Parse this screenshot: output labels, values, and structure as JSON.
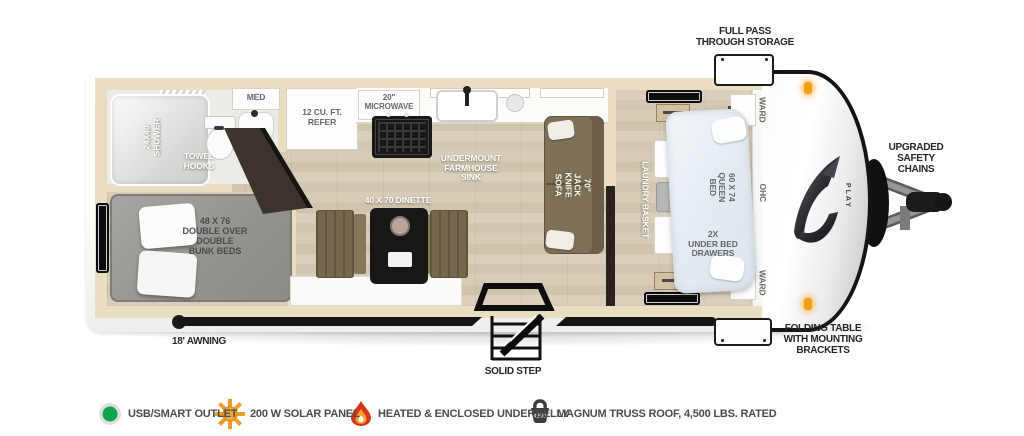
{
  "callouts": {
    "full_pass_through_storage": "FULL PASS\nTHROUGH STORAGE",
    "upgraded_safety_chains": "UPGRADED\nSAFETY\nCHAINS",
    "folding_table": "FOLDING TABLE\nWITH MOUNTING\nBRACKETS",
    "awning": "18' AWNING",
    "solid_step": "SOLID STEP"
  },
  "interior": {
    "shower": "24X40\nSHOWER",
    "towel_hooks": "TOWEL\nHOOKS",
    "med_cabinet": "MED",
    "refrigerator": "12 CU. FT.\nREFER",
    "microwave": "20\"\nMICROWAVE",
    "sink": "UNDERMOUNT\nFARMHOUSE\nSINK",
    "dinette": "40 X 70 DINETTE",
    "sofa": "70\"\nJACK KNIFE SOFA",
    "bunk_beds": "48 X 76\nDOUBLE OVER\nDOUBLE\nBUNK BEDS",
    "laundry_basket": "LAUNDRY BASKET",
    "queen_bed": "60 X 74\nQUEEN BED",
    "under_bed_drawers": "2X\nUNDER BED\nDRAWERS",
    "ward_top": "WARD",
    "ohc": "OHC",
    "ward_bottom": "WARD"
  },
  "front_graphic": {
    "logo_text": "PLAY"
  },
  "legend": {
    "items": [
      {
        "icon": "usb-outlet",
        "label": "USB/SMART OUTLET",
        "color": "#0ea54b"
      },
      {
        "icon": "solar-panel",
        "label": "200 W SOLAR PANEL",
        "color": "#f0a236"
      },
      {
        "icon": "heated-underbelly",
        "label": "HEATED & ENCLOSED UNDERBELLY",
        "color": "#d8341c"
      },
      {
        "icon": "truss-roof-weight",
        "label": "MAGNUM TRUSS ROOF, 4,500 LBS. RATED",
        "badge": "4,500",
        "color": "#3c3c3c"
      }
    ]
  }
}
